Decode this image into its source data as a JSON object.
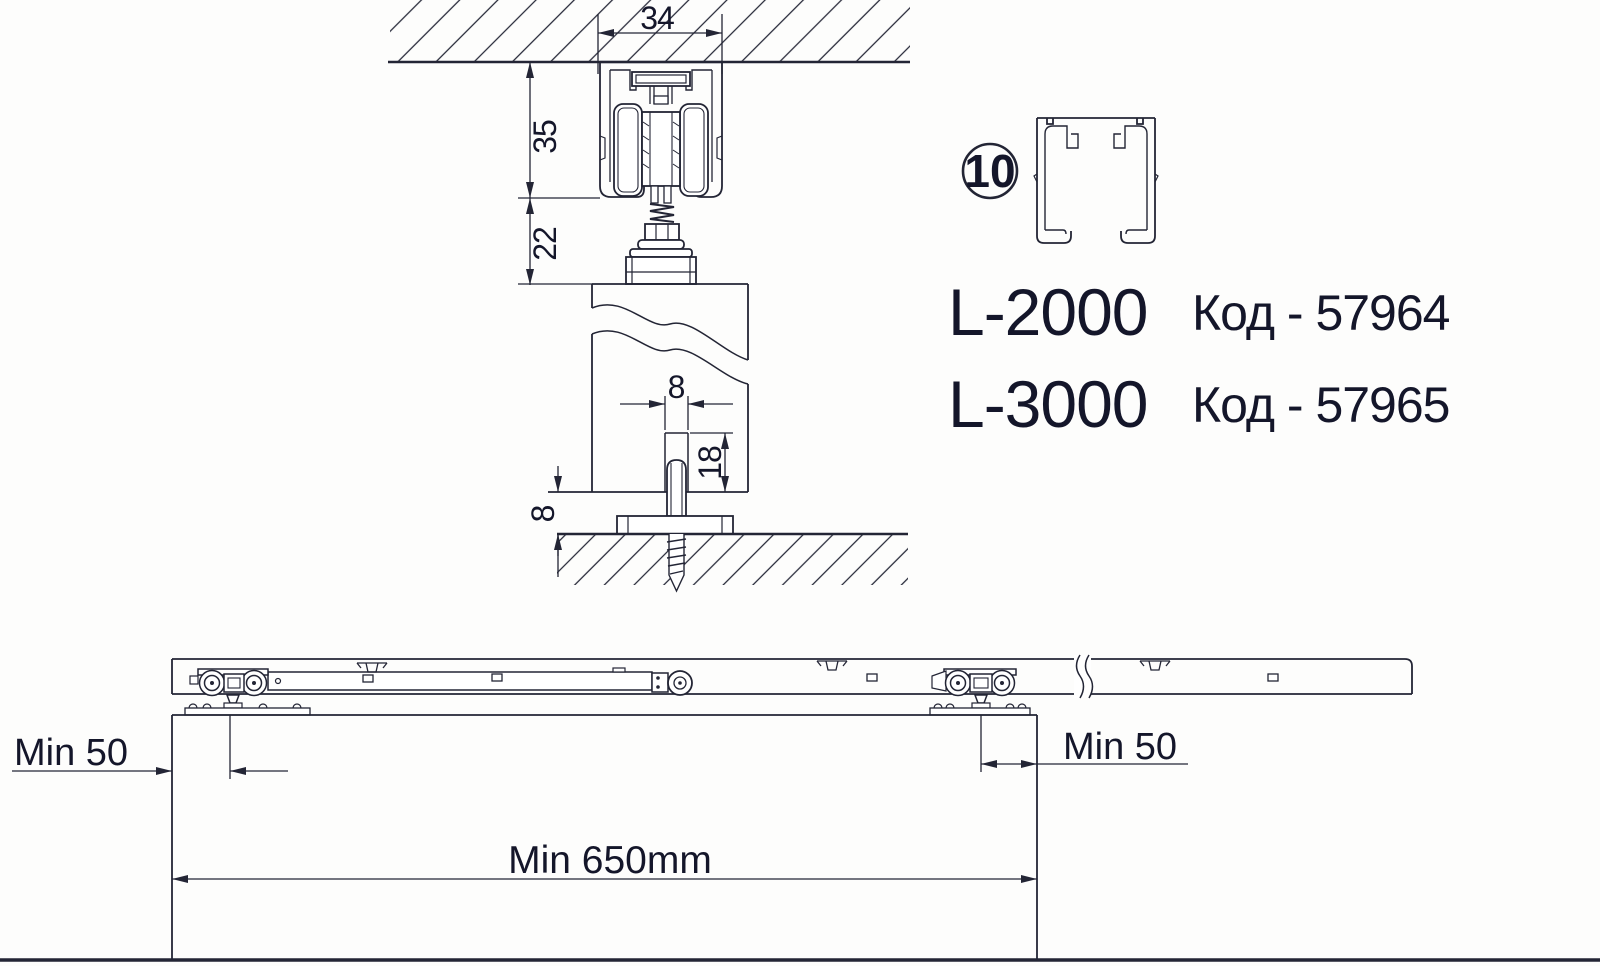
{
  "cross_section": {
    "dim_track_width": "34",
    "dim_track_height": "35",
    "dim_clearance_top": "22",
    "dim_groove_width": "8",
    "dim_groove_depth": "18",
    "dim_floor_gap": "8"
  },
  "legend": {
    "callout_number": "10",
    "products": [
      {
        "model": "L-2000",
        "code_label": "Код - 57964"
      },
      {
        "model": "L-3000",
        "code_label": "Код - 57965"
      }
    ]
  },
  "side_view": {
    "dim_offset_left": "Min 50",
    "dim_offset_right": "Min 50",
    "dim_min_door_width": "Min 650mm"
  },
  "colors": {
    "line": "#232535",
    "text": "#14162a",
    "background": "#fdfdfc"
  }
}
